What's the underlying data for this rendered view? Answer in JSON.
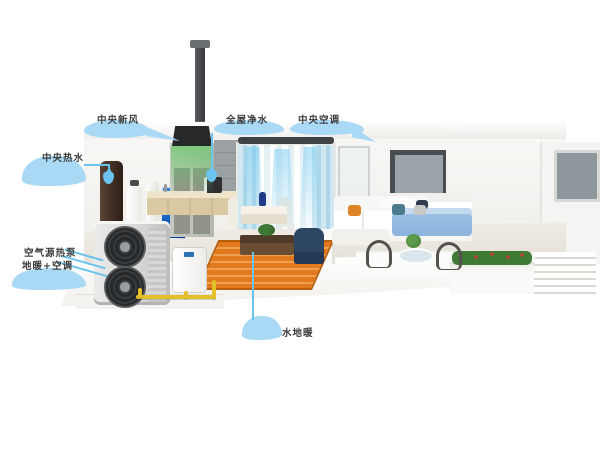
{
  "labels": {
    "fresh_air": "中央新风",
    "hot_water": "中央热水",
    "water_purifier": "全屋净水",
    "central_ac": "中央空调",
    "product_line1": "空气源热泵",
    "product_line2": "地暖+空调",
    "floor_heating": "水地暖"
  },
  "colors": {
    "label_cloud": "#a9d9f4",
    "label_leader": "#6cc3ee",
    "label_text": "#3c3c3c",
    "pipe_yellow": "#e3bf2a",
    "rug_orange": "#e2791c",
    "air_blue": "#9fdbf2",
    "glow_green": "#5ecb5e",
    "bed_blue": "#9fc3e6",
    "screen_blue": "#1668c8",
    "hood_dark": "#26282a",
    "tank_brown": "#4a342a"
  }
}
